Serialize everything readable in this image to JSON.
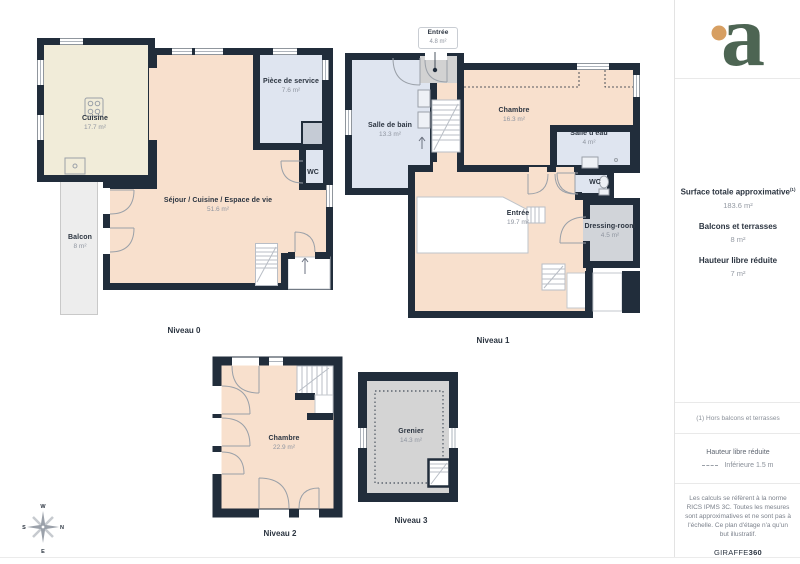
{
  "palette": {
    "wall": "#212d3b",
    "room_cream": "#f1ecd9",
    "room_peach": "#f8e0cd",
    "room_blue": "#dfe5f0",
    "room_gray": "#d4d4d4",
    "dressing_gray": "#d1d4d9",
    "balcony_gray": "#ededed",
    "label_dark": "#2b3440",
    "label_gray": "#8f95a0",
    "logo_green": "#4d6553",
    "logo_orange": "#d79f62"
  },
  "levels": [
    {
      "id": "niveau-0",
      "caption": "Niveau 0",
      "rooms": [
        {
          "name": "Cuisine",
          "area": "17.7 m²"
        },
        {
          "name": "Séjour / Cuisine / Espace de vie",
          "area": "51.6 m²"
        },
        {
          "name": "Pièce de service",
          "area": "7.6 m²"
        },
        {
          "name": "WC",
          "area": ""
        },
        {
          "name": "Balcon",
          "area": "8 m²"
        }
      ]
    },
    {
      "id": "niveau-1",
      "caption": "Niveau 1",
      "entry_callout": {
        "name": "Entrée",
        "area": "4.8 m²"
      },
      "rooms": [
        {
          "name": "Salle de bain",
          "area": "13.3 m²"
        },
        {
          "name": "Chambre",
          "area": "16.3 m²"
        },
        {
          "name": "Salle d'eau",
          "area": "4 m²"
        },
        {
          "name": "WC",
          "area": ""
        },
        {
          "name": "Entrée",
          "area": "19.7 m²"
        },
        {
          "name": "Dressing-room",
          "area": "4.5 m²"
        }
      ]
    },
    {
      "id": "niveau-2",
      "caption": "Niveau 2",
      "rooms": [
        {
          "name": "Chambre",
          "area": "22.9 m²"
        }
      ]
    },
    {
      "id": "niveau-3",
      "caption": "Niveau 3",
      "rooms": [
        {
          "name": "Grenier",
          "area": "14.3 m²"
        }
      ]
    }
  ],
  "compass": {
    "top": "W",
    "right": "N",
    "bottom": "E",
    "left": "S"
  },
  "sidebar": {
    "logo_letter": "a",
    "stats": [
      {
        "label": "Surface totale approximative",
        "sup": "(1)",
        "value": "183.6 m²"
      },
      {
        "label": "Balcons et terrasses",
        "value": "8 m²"
      },
      {
        "label": "Hauteur libre réduite",
        "value": "7 m²"
      }
    ],
    "footnote": "(1) Hors balcons et terrasses",
    "legend_title": "Hauteur libre réduite",
    "legend_item": "Inférieure 1.5 m",
    "disclaimer": "Les calculs se réfèrent à la norme RICS IPMS 3C. Toutes les mesures sont approximatives et ne sont pas à l'échelle. Ce plan d'étage n'a qu'un but illustratif.",
    "brand": {
      "name": "GIRAFFE",
      "suffix": "360"
    }
  }
}
